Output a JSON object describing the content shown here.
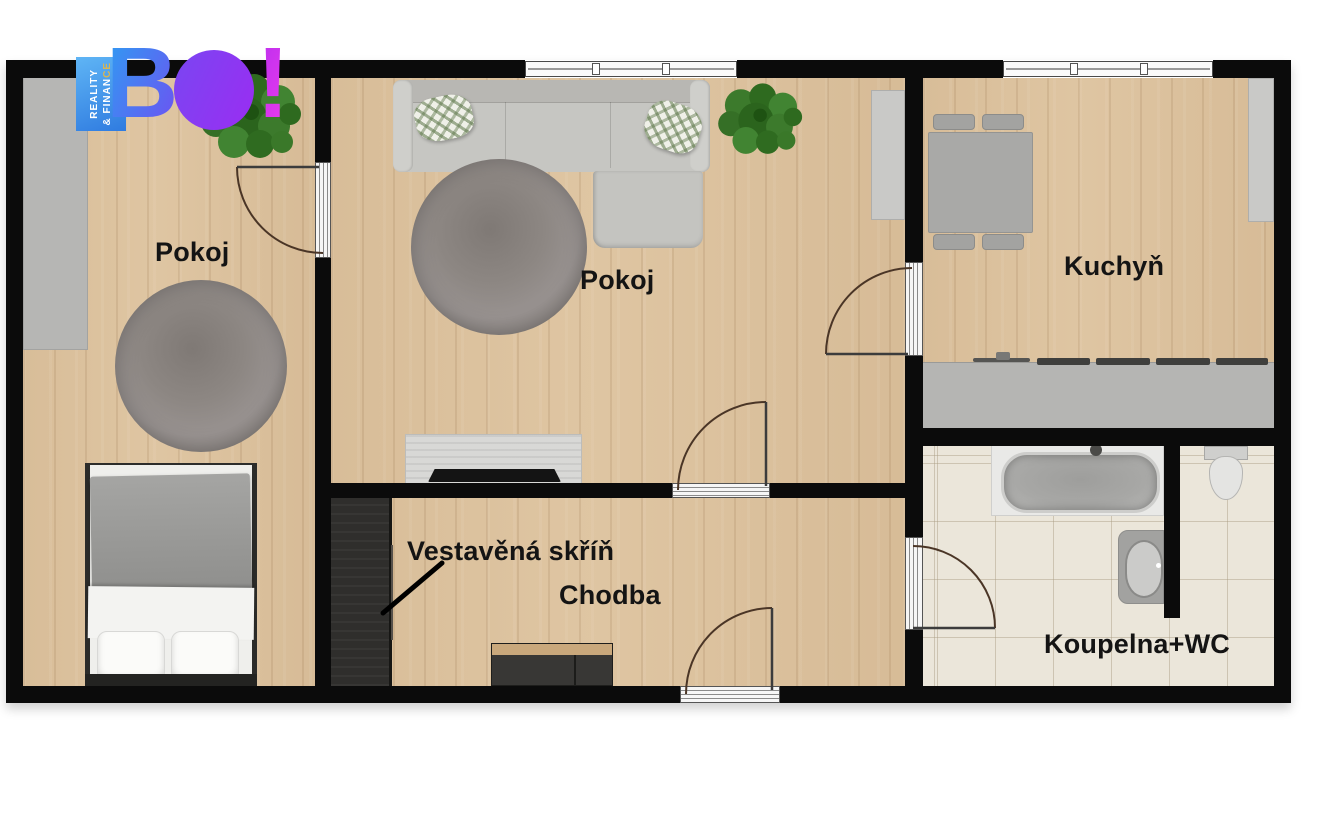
{
  "logo": {
    "brand": "BO!",
    "brand_b": "B",
    "brand_o": "O",
    "brand_bang": "!",
    "tagline_line1": "REALITY",
    "tagline_line2_main": "& FINAN",
    "tagline_line2_accent": "CE",
    "accent_color": "#d8b554",
    "gradient_colors": [
      "#2e9df2",
      "#6d52f2",
      "#9a2df2",
      "#ef3bee"
    ],
    "tagline_bg": "#3a8ae8"
  },
  "rooms": {
    "room1": {
      "label": "Pokoj"
    },
    "living_room": {
      "label": "Pokoj"
    },
    "kitchen": {
      "label": "Kuchyň"
    },
    "hallway": {
      "label": "Chodba"
    },
    "built_in_wardrobe": {
      "label": "Vestavěná skříň"
    },
    "bathroom": {
      "label": "Koupelna+WC"
    }
  },
  "colors": {
    "wall": "#0b0b0b",
    "wood_floor": "#ddc4a1",
    "tile_floor": "#ebe6da",
    "label_text": "#141414",
    "plant_green": "#3c7a2c",
    "rug_gray": "#8d8783"
  }
}
